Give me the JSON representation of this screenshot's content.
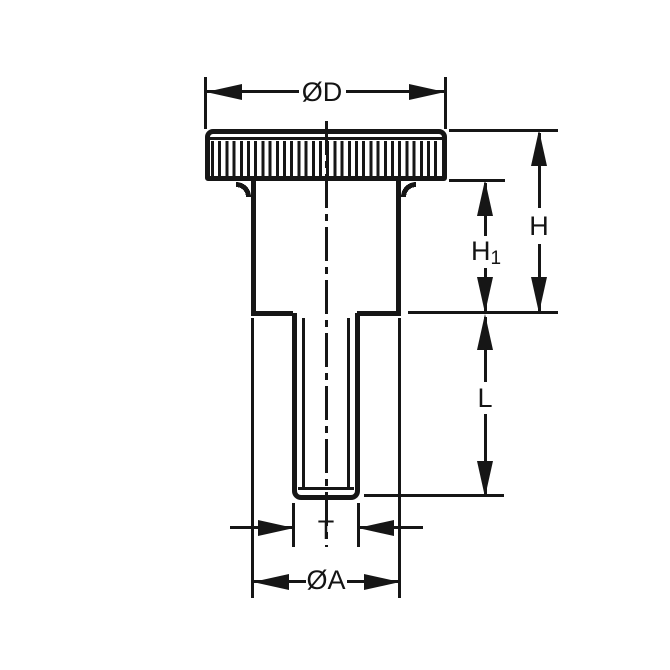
{
  "dimensions": {
    "head_diameter": {
      "label": "ØD"
    },
    "overall_height": {
      "label": "H"
    },
    "shoulder_height": {
      "label_base": "H",
      "label_sub": "1"
    },
    "thread_length": {
      "label": "L"
    },
    "thread_size": {
      "label": "T"
    },
    "shoulder_diameter": {
      "label": "ØA"
    }
  },
  "colors": {
    "line": "#161616",
    "background": "#ffffff"
  }
}
